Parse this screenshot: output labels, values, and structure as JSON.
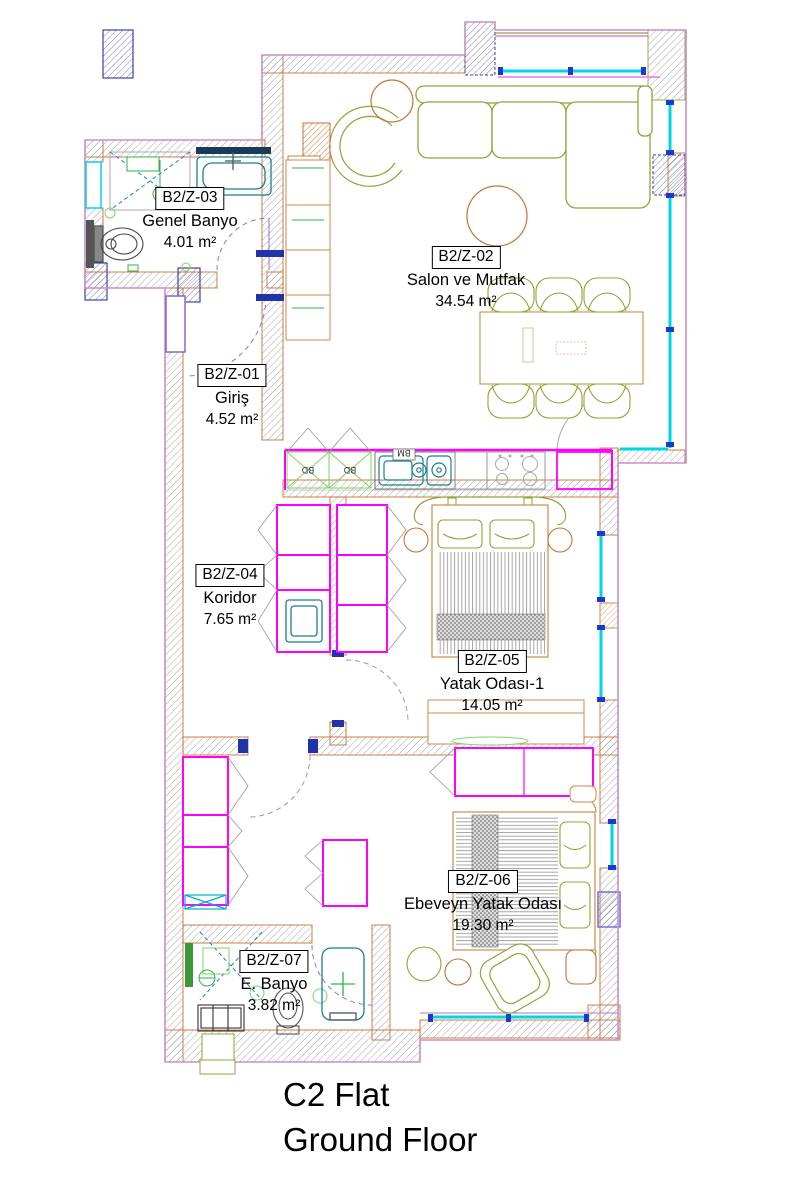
{
  "drawing": {
    "title_line1": "C2 Flat",
    "title_line2": "Ground Floor"
  },
  "rooms": {
    "z01": {
      "code": "B2/Z-01",
      "name": "Giriş",
      "area": "4.52 m²"
    },
    "z02": {
      "code": "B2/Z-02",
      "name": "Salon ve Mutfak",
      "area": "34.54 m²"
    },
    "z03": {
      "code": "B2/Z-03",
      "name": "Genel Banyo",
      "area": "4.01 m²"
    },
    "z04": {
      "code": "B2/Z-04",
      "name": "Koridor",
      "area": "7.65 m²"
    },
    "z05": {
      "code": "B2/Z-05",
      "name": "Yatak Odası-1",
      "area": "14.05 m²"
    },
    "z06": {
      "code": "B2/Z-06",
      "name": "Ebeveyn Yatak Odası",
      "area": "19.30 m²"
    },
    "z07": {
      "code": "B2/Z-07",
      "name": "E. Banyo",
      "area": "3.82 m²"
    }
  },
  "fixtures": {
    "cabinet_label_1": "BD",
    "cabinet_label_2": "BD",
    "sink_label": "BM"
  },
  "colors": {
    "wall_hatch": "#9a9a9a",
    "exterior_line": "#c87137",
    "boundary_violet": "#c690c6",
    "interior_magenta": "#ff00ff",
    "window_cyan": "#00d4e8",
    "wood_furniture": "#cd8a4a",
    "soft_furniture_olive": "#8fa436",
    "sanitary_teal": "#1a7f8e",
    "kitchen_green": "#7fd45f",
    "door_arc_violet": "#8877cc",
    "shower_blue": "#2277cc",
    "tick_navy": "#1a3acc"
  }
}
